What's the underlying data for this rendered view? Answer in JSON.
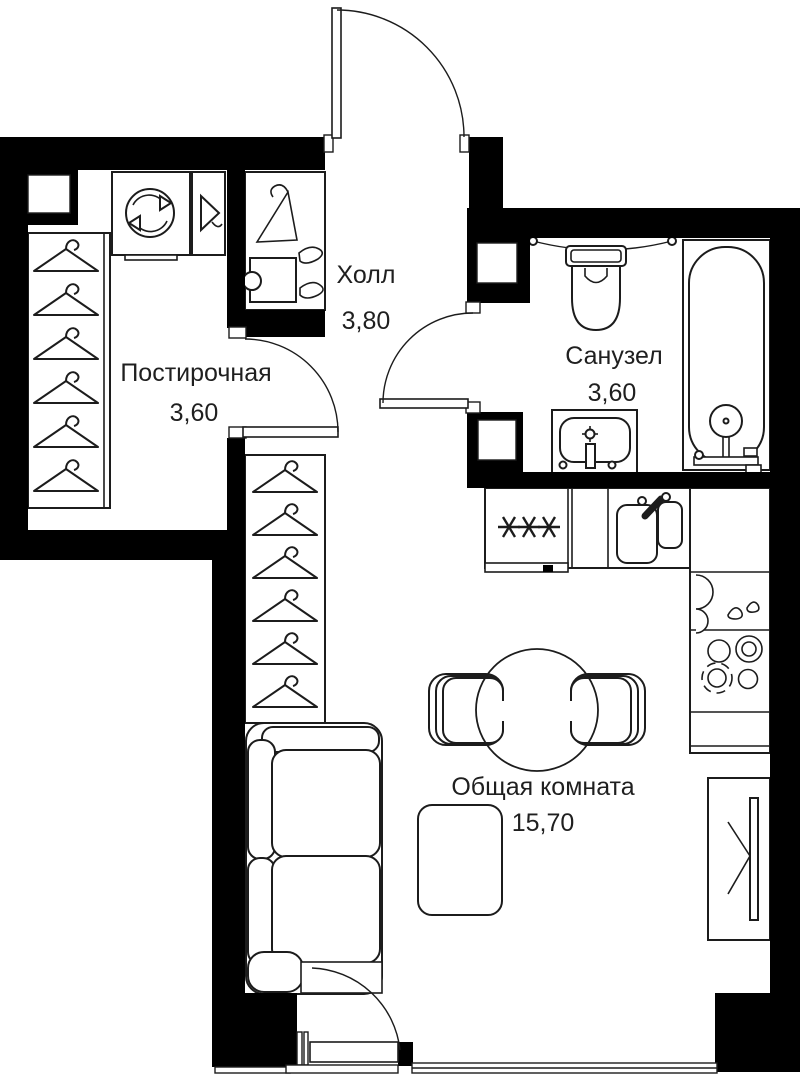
{
  "title": "Studio apartment floor plan",
  "colors": {
    "wall": "#000000",
    "line": "#1c1c1c",
    "background": "#ffffff",
    "text": "#1f1f1f"
  },
  "rooms": [
    {
      "id": "laundry",
      "name": "Постирочная",
      "area": "3,60"
    },
    {
      "id": "hall",
      "name": "Холл",
      "area": "3,80"
    },
    {
      "id": "bathroom",
      "name": "Санузел",
      "area": "3,60"
    },
    {
      "id": "living",
      "name": "Общая комната",
      "area": "15,70"
    }
  ],
  "fixtures": [
    "entrance-door",
    "laundry-door",
    "bathroom-door",
    "balcony-door",
    "window",
    "washing-machine",
    "laundry-cabinet",
    "wardrobe-hangers",
    "hall-shoe-rack",
    "toilet",
    "towel-rail",
    "bathroom-sink",
    "bathtub",
    "shower",
    "kitchen-counter",
    "cooktop-marks",
    "kitchen-sink",
    "drainer",
    "stove-burners",
    "dining-table",
    "chair",
    "coffee-table",
    "sofa",
    "wardrobe-sliding"
  ]
}
